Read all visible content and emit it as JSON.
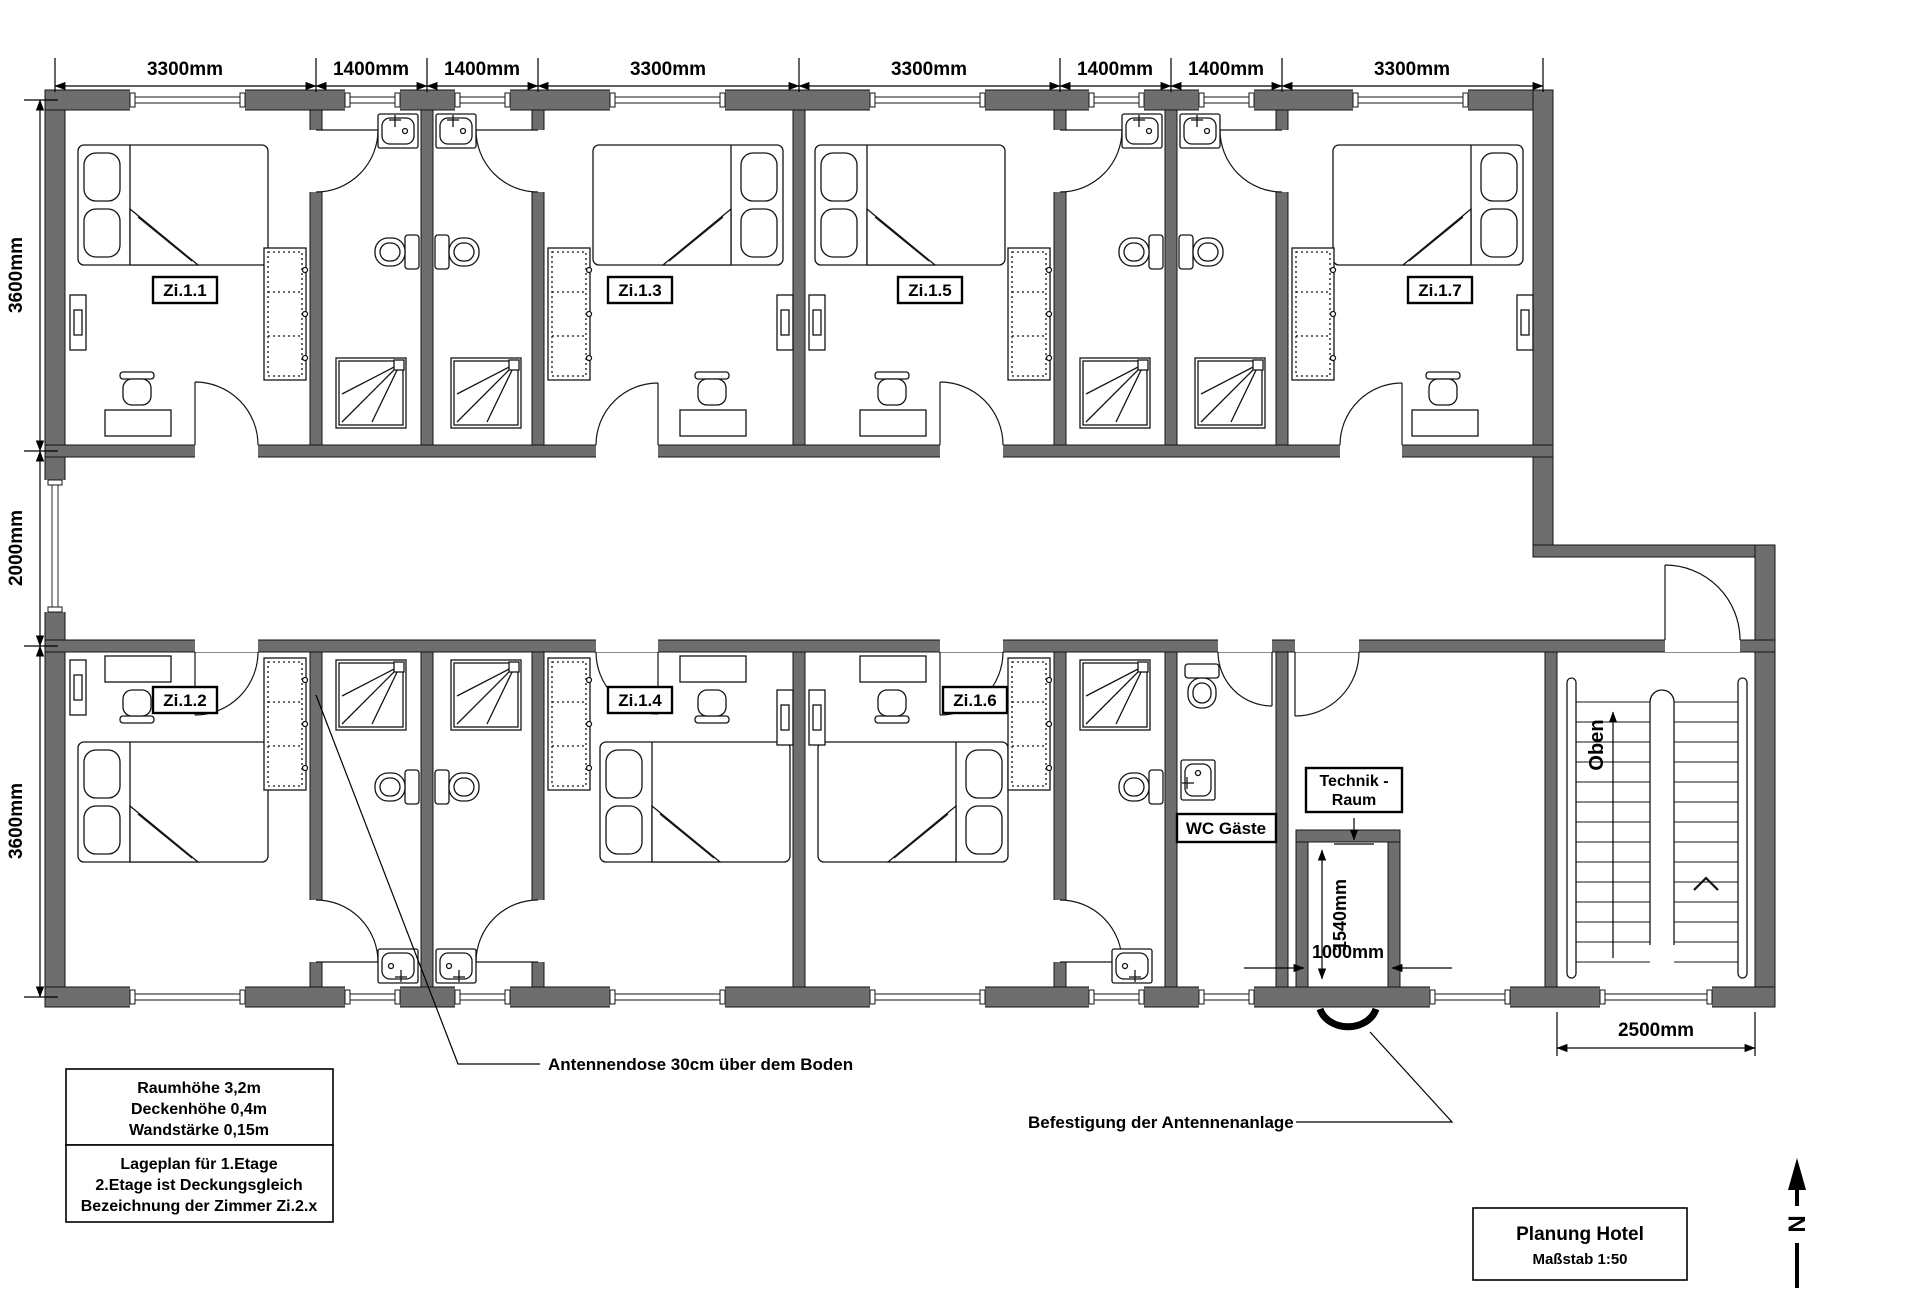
{
  "drawing": {
    "title_block": {
      "line1": "Planung Hotel",
      "line2": "Maßstab 1:50"
    },
    "compass": {
      "north_label": "N"
    },
    "notes": {
      "box1": [
        "Raumhöhe 3,2m",
        "Deckenhöhe 0,4m",
        "Wandstärke 0,15m"
      ],
      "box2": [
        "Lageplan für 1.Etage",
        "2.Etage ist Deckungsgleich",
        "Bezeichnung der Zimmer Zi.2.x"
      ]
    },
    "annotations": {
      "antenna_socket": "Antennendose 30cm über dem Boden",
      "antenna_mount": "Befestigung der Antennenanlage"
    },
    "dimensions": {
      "top": [
        "3300mm",
        "1400mm",
        "1400mm",
        "3300mm",
        "3300mm",
        "1400mm",
        "1400mm",
        "3300mm"
      ],
      "left": [
        "3600mm",
        "2000mm",
        "3600mm"
      ],
      "stairwell_width": "2500mm",
      "shaft_height": "1540mm",
      "shaft_width": "1000mm"
    },
    "rooms": {
      "zi11": "Zi.1.1",
      "zi12": "Zi.1.2",
      "zi13": "Zi.1.3",
      "zi14": "Zi.1.4",
      "zi15": "Zi.1.5",
      "zi16": "Zi.1.6",
      "zi17": "Zi.1.7",
      "wc_guests": "WC Gäste",
      "technik_line1": "Technik -",
      "technik_line2": "Raum",
      "stairs_up": "Oben"
    },
    "colors": {
      "wall_fill": "#6e6e6e",
      "line": "#000000",
      "background": "#ffffff"
    }
  }
}
